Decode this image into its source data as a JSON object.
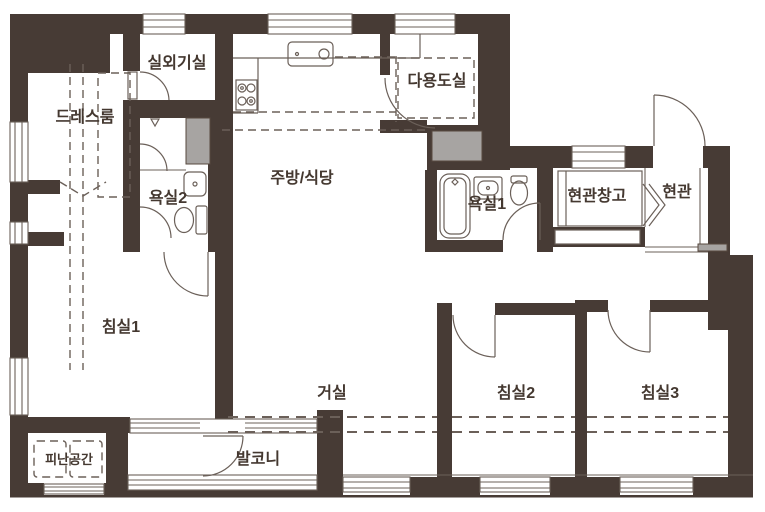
{
  "title": "apartment-floorplan",
  "colors": {
    "wall": "#473b35",
    "duct": "#a7a4a2",
    "line": "#6b6059",
    "dash": "#6b6059",
    "text": "#443830",
    "background": "#ffffff"
  },
  "rooms": {
    "outdoor_unit": "실외기실",
    "dress_room": "드레스룸",
    "bathroom2": "욕실2",
    "kitchen_dining": "주방/식당",
    "utility": "다용도실",
    "bathroom1": "욕실1",
    "entry_storage": "현관창고",
    "entry": "현관",
    "bedroom1": "침실1",
    "living": "거실",
    "bedroom2": "침실2",
    "bedroom3": "침실3",
    "refuge": "피난공간",
    "balcony": "발코니"
  }
}
